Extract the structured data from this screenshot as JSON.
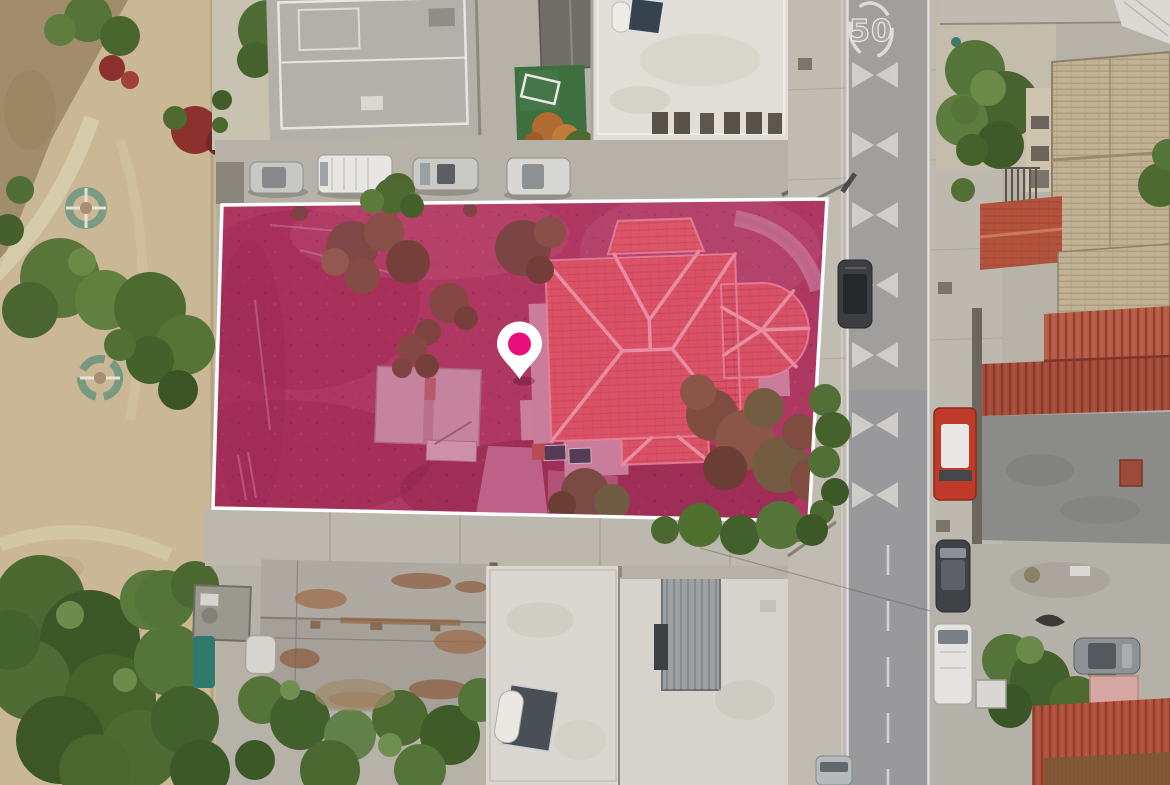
{
  "photo": {
    "kind": "aerial-drone-photo-of-residential-block",
    "road": {
      "speed_marking": "50"
    },
    "parcel_overlay": {
      "polygon_points": "222,205 827,199 809,521 213,508",
      "fill_color": "#d4116f",
      "fill_opacity": "0.17",
      "border_color": "#ffffff",
      "border_width": "3.5"
    },
    "location_pin": {
      "body_color": "#ffffff",
      "dot_color": "#e80f7d"
    }
  }
}
